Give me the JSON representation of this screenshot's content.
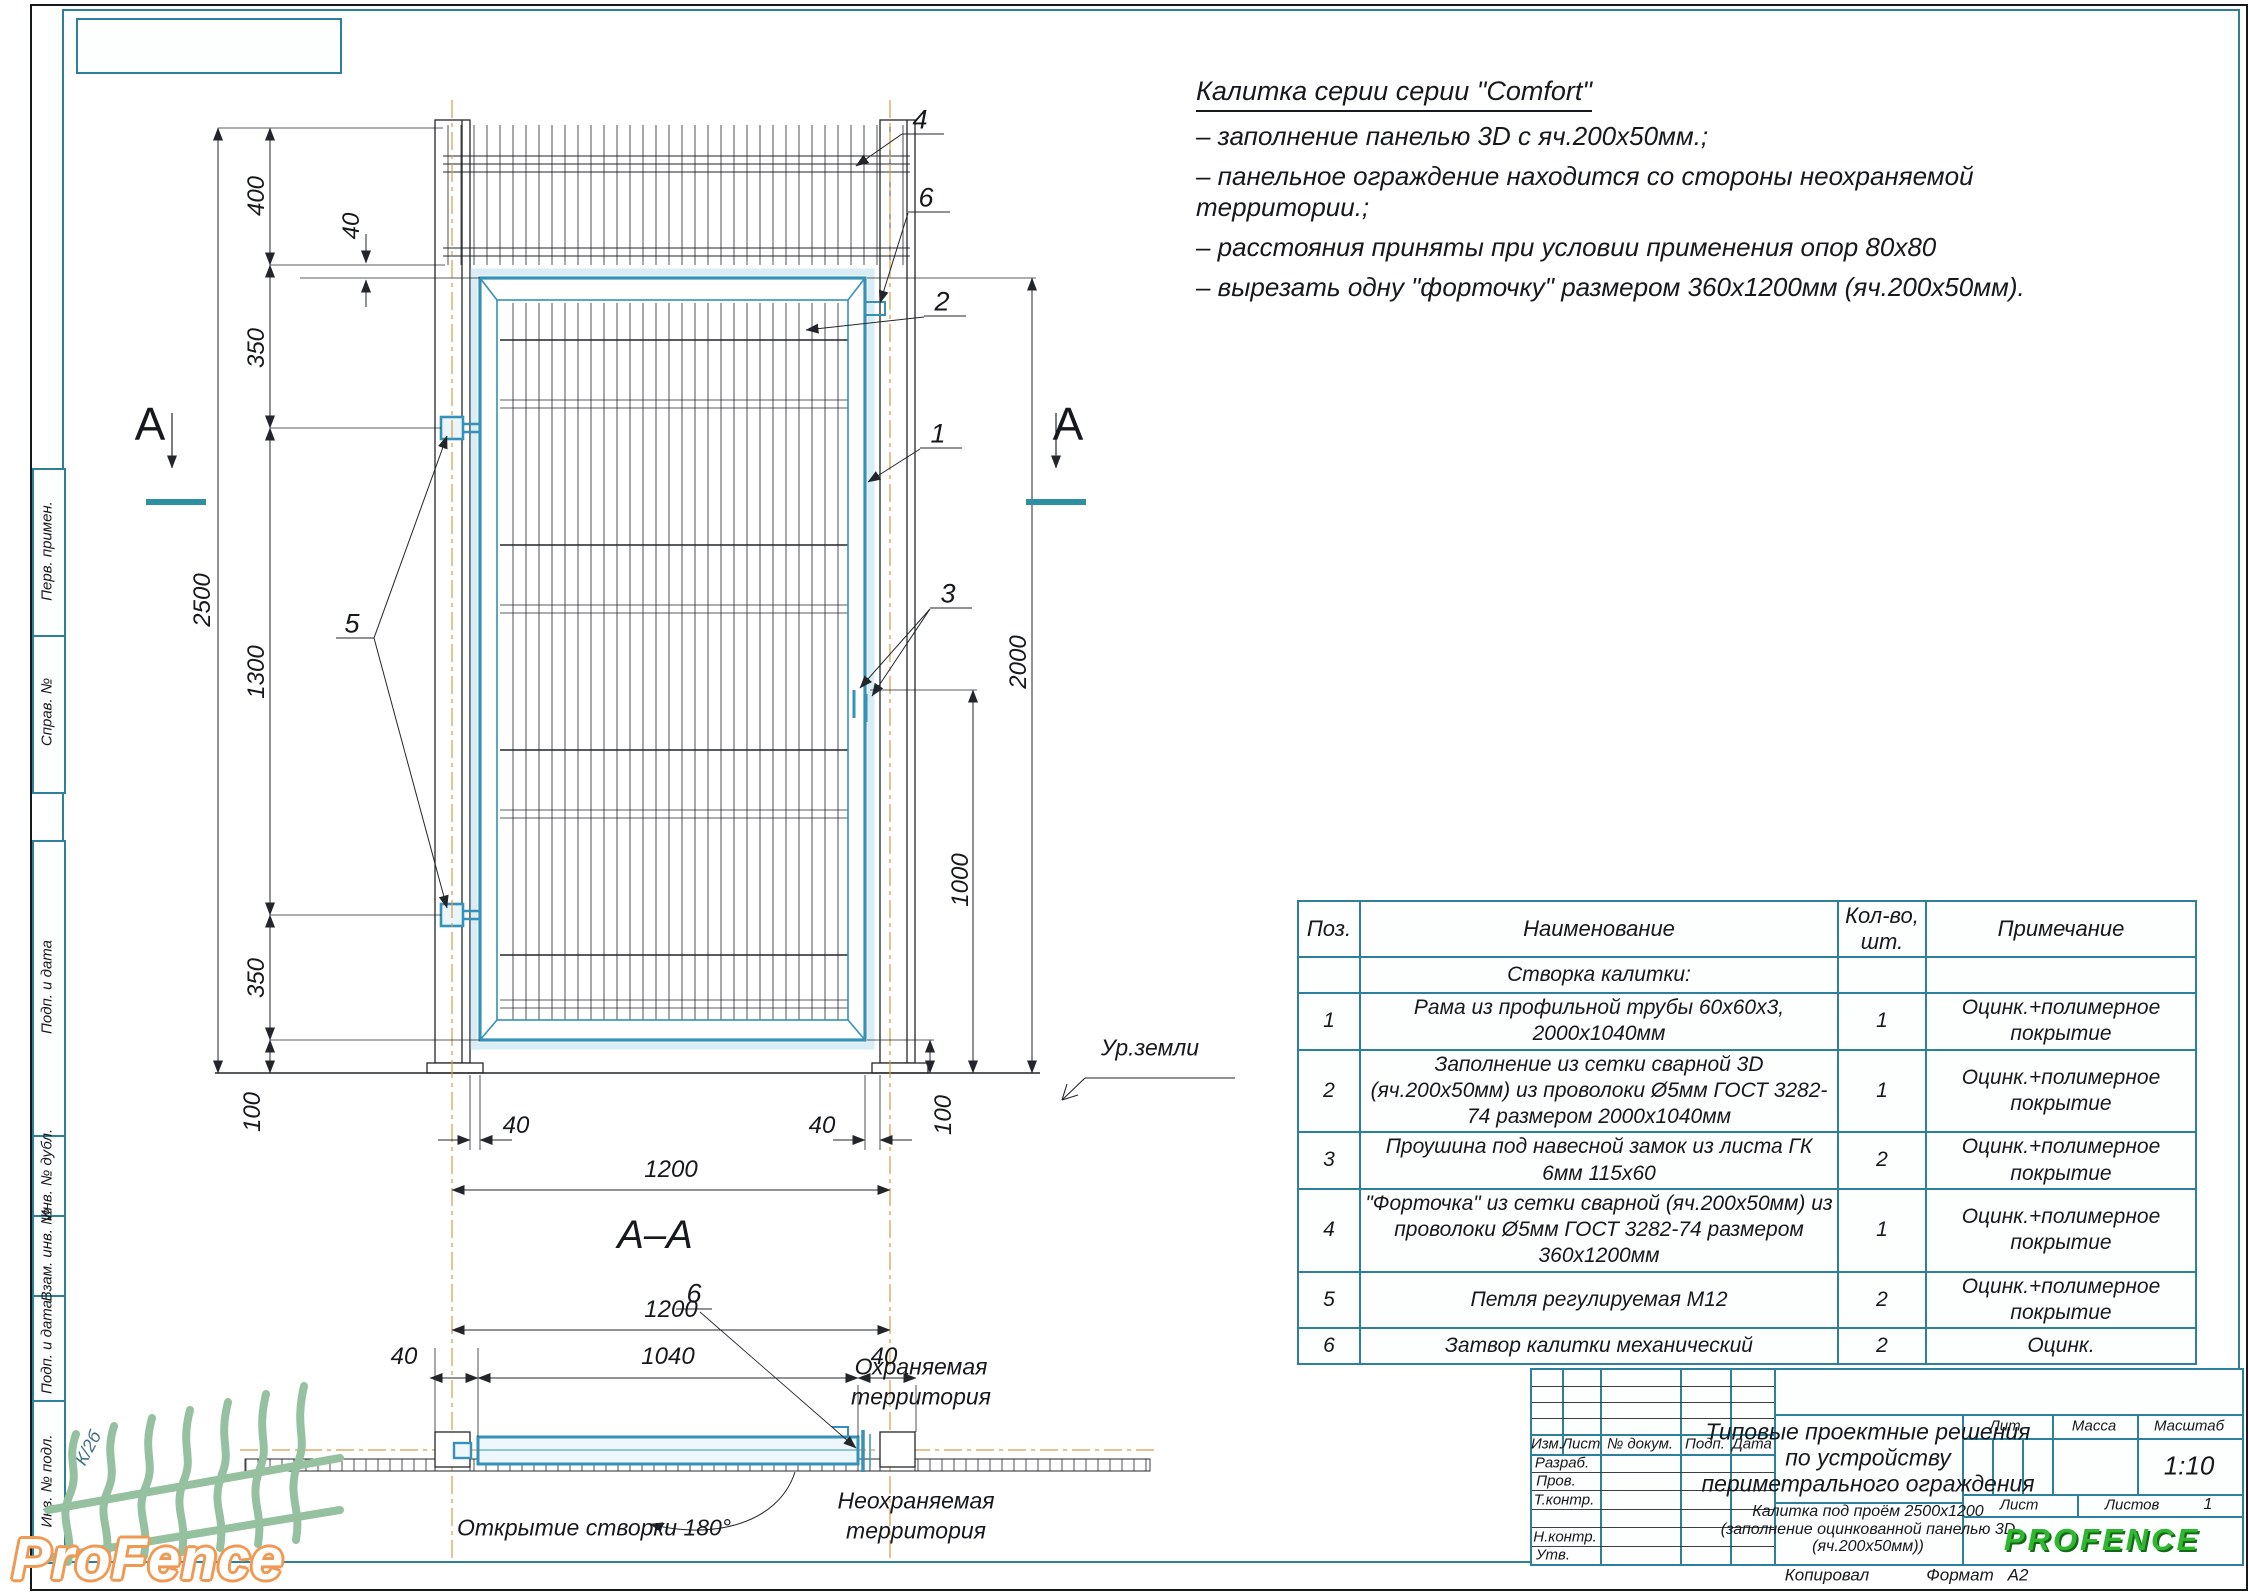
{
  "colors": {
    "frame_teal": "#2e7f9c",
    "gate_blue": "#3691b8",
    "centerline_orange": "#d79b4a",
    "brand_green": "#2fb82f",
    "logo_orange": "#ef9952"
  },
  "sheet": {
    "copied_label": "Копировал",
    "format_label": "Формат",
    "format_value": "А2"
  },
  "notes": {
    "title": "Калитка серии серии \"Comfort\"",
    "lines": [
      "– заполнение панелью 3D с яч.200х50мм.;",
      "– панельное ограждение находится со стороны неохраняемой территории.;",
      "– расстояния приняты при условии применения опор 80х80",
      "– вырезать одну \"форточку\" размером 360х1200мм (яч.200х50мм)."
    ]
  },
  "drawing": {
    "section_cut_label": "A",
    "section_title": "А–А",
    "ground_label": "Ур.земли",
    "dims": {
      "overall_height": "2500",
      "panel_height": "400",
      "gap_top": "40",
      "hinge_top_offset": "350",
      "hinge_spacing": "1300",
      "hinge_bottom_offset": "350",
      "clearance_left": "100",
      "clearance_right": "100",
      "gate_height": "2000",
      "latch_height": "1000",
      "post_gap_left": "40",
      "post_gap_right": "40",
      "opening_width": "1200"
    },
    "callouts": {
      "c1": "1",
      "c2": "2",
      "c3": "3",
      "c4": "4",
      "c5": "5",
      "c6": "6",
      "c6_bottom": "6"
    }
  },
  "section": {
    "dims": {
      "opening_width": "1200",
      "gap_left": "40",
      "frame_width": "1040",
      "gap_right": "40"
    },
    "swing_label": "Открытие створки 180°",
    "protected_area_line1": "Охраняемая",
    "protected_area_line2": "территория",
    "unprotected_area_line1": "Неохраняемая",
    "unprotected_area_line2": "территория"
  },
  "spec_table": {
    "headers": {
      "pos": "Поз.",
      "name": "Наименование",
      "qty": "Кол-во, шт.",
      "note": "Примечание"
    },
    "group": "Створка калитки:",
    "rows": [
      {
        "pos": "1",
        "name": "Рама из профильной трубы 60х60х3, 2000х1040мм",
        "qty": "1",
        "note": "Оцинк.+полимерное покрытие"
      },
      {
        "pos": "2",
        "name": "Заполнение из сетки сварной 3D (яч.200х50мм) из проволоки Ø5мм ГОСТ 3282-74 размером 2000х1040мм",
        "qty": "1",
        "note": "Оцинк.+полимерное покрытие"
      },
      {
        "pos": "3",
        "name": "Проушина под навесной замок из листа ГК 6мм 115х60",
        "qty": "2",
        "note": "Оцинк.+полимерное покрытие"
      },
      {
        "pos": "4",
        "name": "\"Форточка\" из сетки сварной (яч.200х50мм) из проволоки Ø5мм ГОСТ 3282-74 размером 360х1200мм",
        "qty": "1",
        "note": "Оцинк.+полимерное покрытие"
      },
      {
        "pos": "5",
        "name": "Петля регулируемая М12",
        "qty": "2",
        "note": "Оцинк.+полимерное покрытие"
      },
      {
        "pos": "6",
        "name": "Затвор калитки механический",
        "qty": "2",
        "note": "Оцинк."
      }
    ]
  },
  "title_block": {
    "rev_headers": {
      "izm": "Изм.",
      "list": "Лист",
      "doc": "№ докум.",
      "sign": "Подп.",
      "date": "Дата"
    },
    "roles": {
      "r1": "Разраб.",
      "r2": "Пров.",
      "r3": "Т.контр.",
      "r4": "Н.контр.",
      "r5": "Утв."
    },
    "title_lines": [
      "Типовые проектные решения",
      "по устройству",
      "периметрального ограждения"
    ],
    "doc_lines": [
      "Калитка под проём 2500х1200",
      "(заполнение оцинкованной панелью 3D",
      "(яч.200х50мм))"
    ],
    "lit_label": "Лит.",
    "mass_label": "Масса",
    "scale_label": "Масштаб",
    "scale_value": "1:10",
    "sheet_label": "Лист",
    "sheets_label": "Листов",
    "sheets_value": "1",
    "brand": "PROFENCE"
  },
  "frame_labels": {
    "b1": "Перв. примен.",
    "b2": "Справ. №",
    "b3": "Подп. и дата",
    "b4": "Инв. № дубл.",
    "b5": "Взам. инв. №",
    "b6": "Подп. и дата",
    "b7": "Инв. № подл.",
    "handwritten": "К/2б"
  },
  "logo": {
    "wordmark": "ProFence"
  }
}
